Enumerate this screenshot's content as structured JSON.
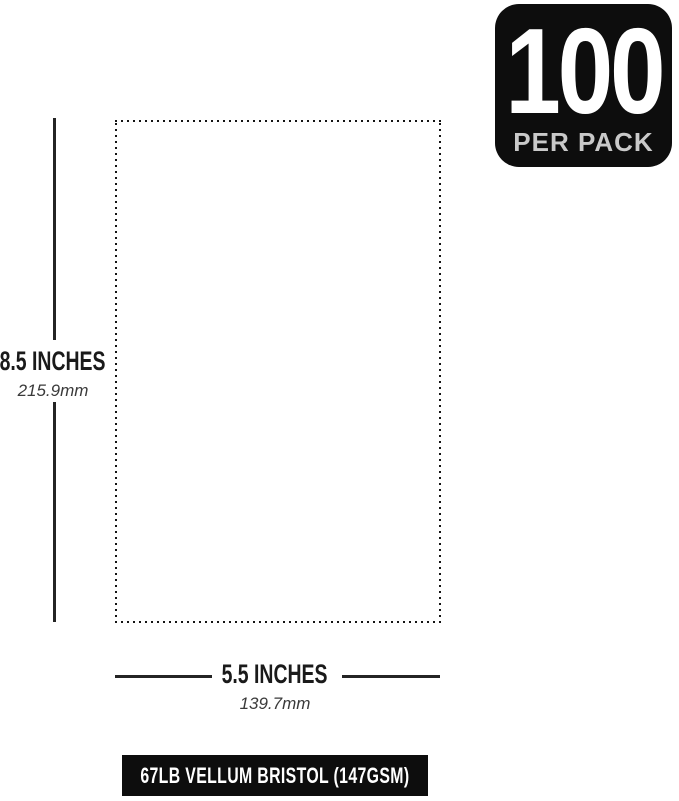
{
  "colors": {
    "background": "#ffffff",
    "ink": "#242424",
    "text": "#1a1a1a",
    "metric_text": "#3a3a3a",
    "badge_background": "#0d0d0d",
    "badge_number_color": "#ffffff",
    "badge_label_color": "#c9c9c9",
    "spec_bar_background": "#0d0d0d",
    "spec_bar_text_color": "#ffffff"
  },
  "badge": {
    "number": "100",
    "label": "PER PACK"
  },
  "diagram": {
    "sheet_outline_style": "dotted",
    "height_label": "8.5 INCHES",
    "height_metric": "215.9mm",
    "width_label": "5.5 INCHES",
    "width_metric": "139.7mm"
  },
  "footer": {
    "label": "67LB VELLUM BRISTOL (147GSM)"
  }
}
